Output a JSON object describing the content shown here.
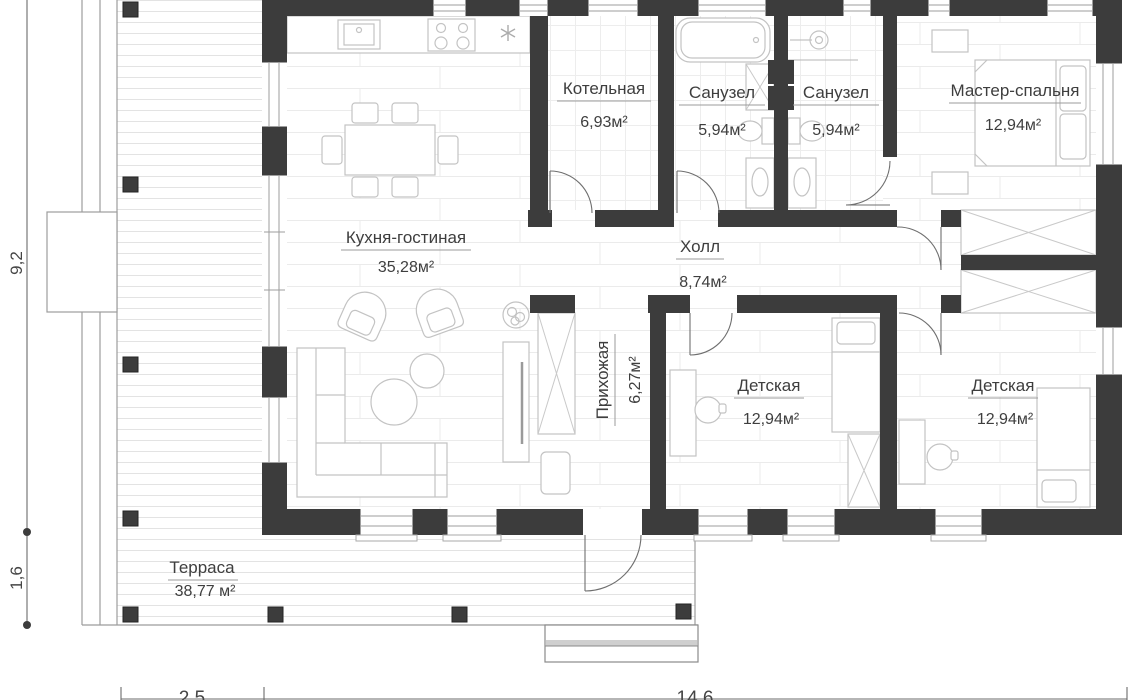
{
  "rooms": {
    "kotelnaya": {
      "name": "Котельная",
      "area": "6,93м²"
    },
    "sanuzel_left": {
      "name": "Санузел",
      "area": "5,94м²"
    },
    "sanuzel_right": {
      "name": "Санузел",
      "area": "5,94м²"
    },
    "master": {
      "name": "Мастер-спальня",
      "area": "12,94м²"
    },
    "kitchen_living": {
      "name": "Кухня-гостиная",
      "area": "35,28м²"
    },
    "hall": {
      "name": "Холл",
      "area": "8,74м²"
    },
    "hallway": {
      "name": "Прихожая",
      "area": "6,27м²"
    },
    "kids_left": {
      "name": "Детская",
      "area": "12,94м²"
    },
    "kids_right": {
      "name": "Детская",
      "area": "12,94м²"
    },
    "terrace": {
      "name": "Терраса",
      "area": "38,77 м²"
    }
  },
  "dimensions": {
    "side_height": "9,2",
    "terrace_depth": "1,6",
    "bottom_left_width": "2,5",
    "bottom_right_width": "14,6"
  },
  "colors": {
    "wall": "#3c3c3c",
    "furniture_outline": "#c3c3c3",
    "floor_line": "#ebebeb",
    "label_text": "#3e3e3e",
    "underline": "#9b9b9b"
  }
}
